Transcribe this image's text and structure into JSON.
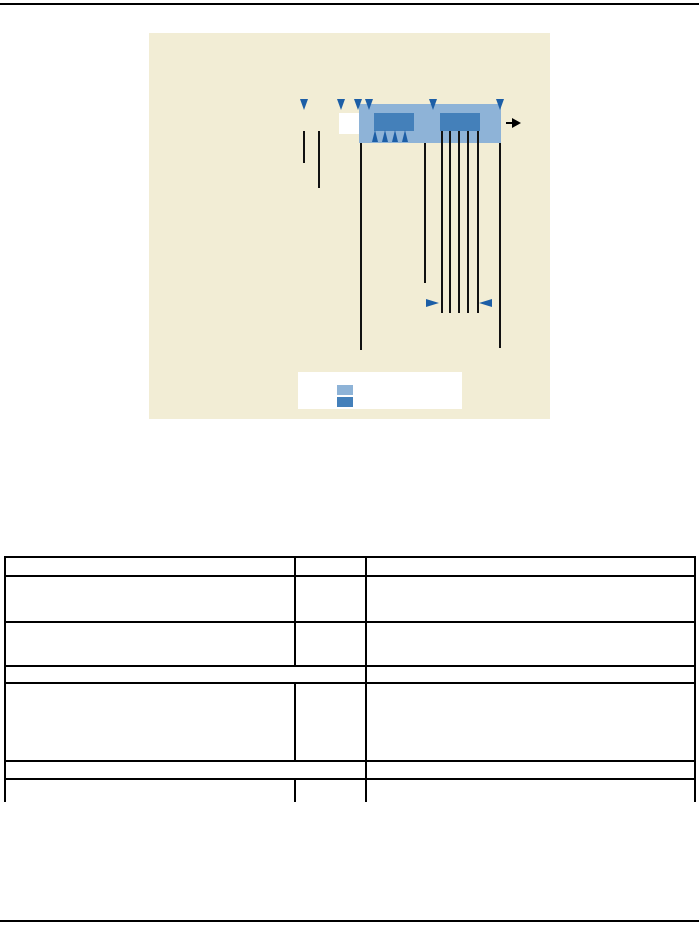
{
  "page": {
    "width": 699,
    "height": 926,
    "top_rule_color": "#000000",
    "bottom_rule_color": "#000000"
  },
  "figure": {
    "frame": {
      "x": 149,
      "y": 33,
      "w": 401,
      "h": 386
    },
    "colors": {
      "panel_background": "#f2edd5",
      "bar": "#8eb3d7",
      "block": "#4480ba",
      "marker": "#1c5ea6",
      "line": "#111111",
      "white_box": "#ffffff",
      "flow_arrow": "#000000"
    },
    "bar": {
      "x": 210,
      "y": 71,
      "w": 142,
      "h": 39
    },
    "white_rect": {
      "x": 190,
      "y": 80,
      "w": 20,
      "h": 21
    },
    "blocks": [
      {
        "x": 225,
        "y": 80,
        "w": 40,
        "h": 18
      },
      {
        "x": 291,
        "y": 80,
        "w": 40,
        "h": 18
      }
    ],
    "down_markers": {
      "y": 66,
      "w": 8,
      "h": 11,
      "xs": [
        155,
        192,
        209,
        220,
        284,
        351
      ]
    },
    "up_markers": {
      "y": 97,
      "w": 7,
      "h": 12,
      "xs": [
        226,
        236,
        246,
        256
      ]
    },
    "drop_lines": [
      {
        "x": 155,
        "y1": 98,
        "y2": 130
      },
      {
        "x": 170,
        "y1": 98,
        "y2": 155
      },
      {
        "x": 212,
        "y1": 110,
        "y2": 317
      },
      {
        "x": 276,
        "y1": 110,
        "y2": 250
      },
      {
        "x": 293,
        "y1": 98,
        "y2": 280
      },
      {
        "x": 301,
        "y1": 98,
        "y2": 280
      },
      {
        "x": 310,
        "y1": 98,
        "y2": 280
      },
      {
        "x": 319,
        "y1": 98,
        "y2": 280
      },
      {
        "x": 329,
        "y1": 98,
        "y2": 280
      },
      {
        "x": 351,
        "y1": 110,
        "y2": 315
      }
    ],
    "span_arrows": [
      {
        "x": 277,
        "y": 266,
        "w": 13,
        "h": 9,
        "dir": "right"
      },
      {
        "x": 330,
        "y": 266,
        "w": 13,
        "h": 9,
        "dir": "left"
      }
    ],
    "flow_arrow": {
      "tail_x": 357,
      "tail_y": 89,
      "tail_w": 6,
      "head_x": 363,
      "head_y": 85,
      "head_w": 9,
      "head_h": 10
    },
    "legend": {
      "box": {
        "x": 149,
        "y": 339,
        "w": 164,
        "h": 37
      },
      "swatches": [
        {
          "x": 39,
          "y": 13,
          "w": 16,
          "h": 10,
          "color": "#8eb3d7"
        },
        {
          "x": 39,
          "y": 25,
          "w": 16,
          "h": 10,
          "color": "#4480ba"
        }
      ]
    }
  },
  "table": {
    "x": 4,
    "y": 556,
    "w": 692,
    "border_color": "#000000",
    "col_widths": [
      288,
      69,
      327
    ],
    "merged_left_width": 359,
    "rows": [
      {
        "h": 19,
        "merged": false,
        "open_bottom": false
      },
      {
        "h": 46,
        "merged": false,
        "open_bottom": false
      },
      {
        "h": 44,
        "merged": false,
        "open_bottom": false
      },
      {
        "h": 17,
        "merged": true,
        "open_bottom": false
      },
      {
        "h": 78,
        "merged": false,
        "open_bottom": false
      },
      {
        "h": 18,
        "merged": true,
        "open_bottom": false
      },
      {
        "h": 22,
        "merged": false,
        "open_bottom": true
      }
    ],
    "cells_text": ""
  }
}
